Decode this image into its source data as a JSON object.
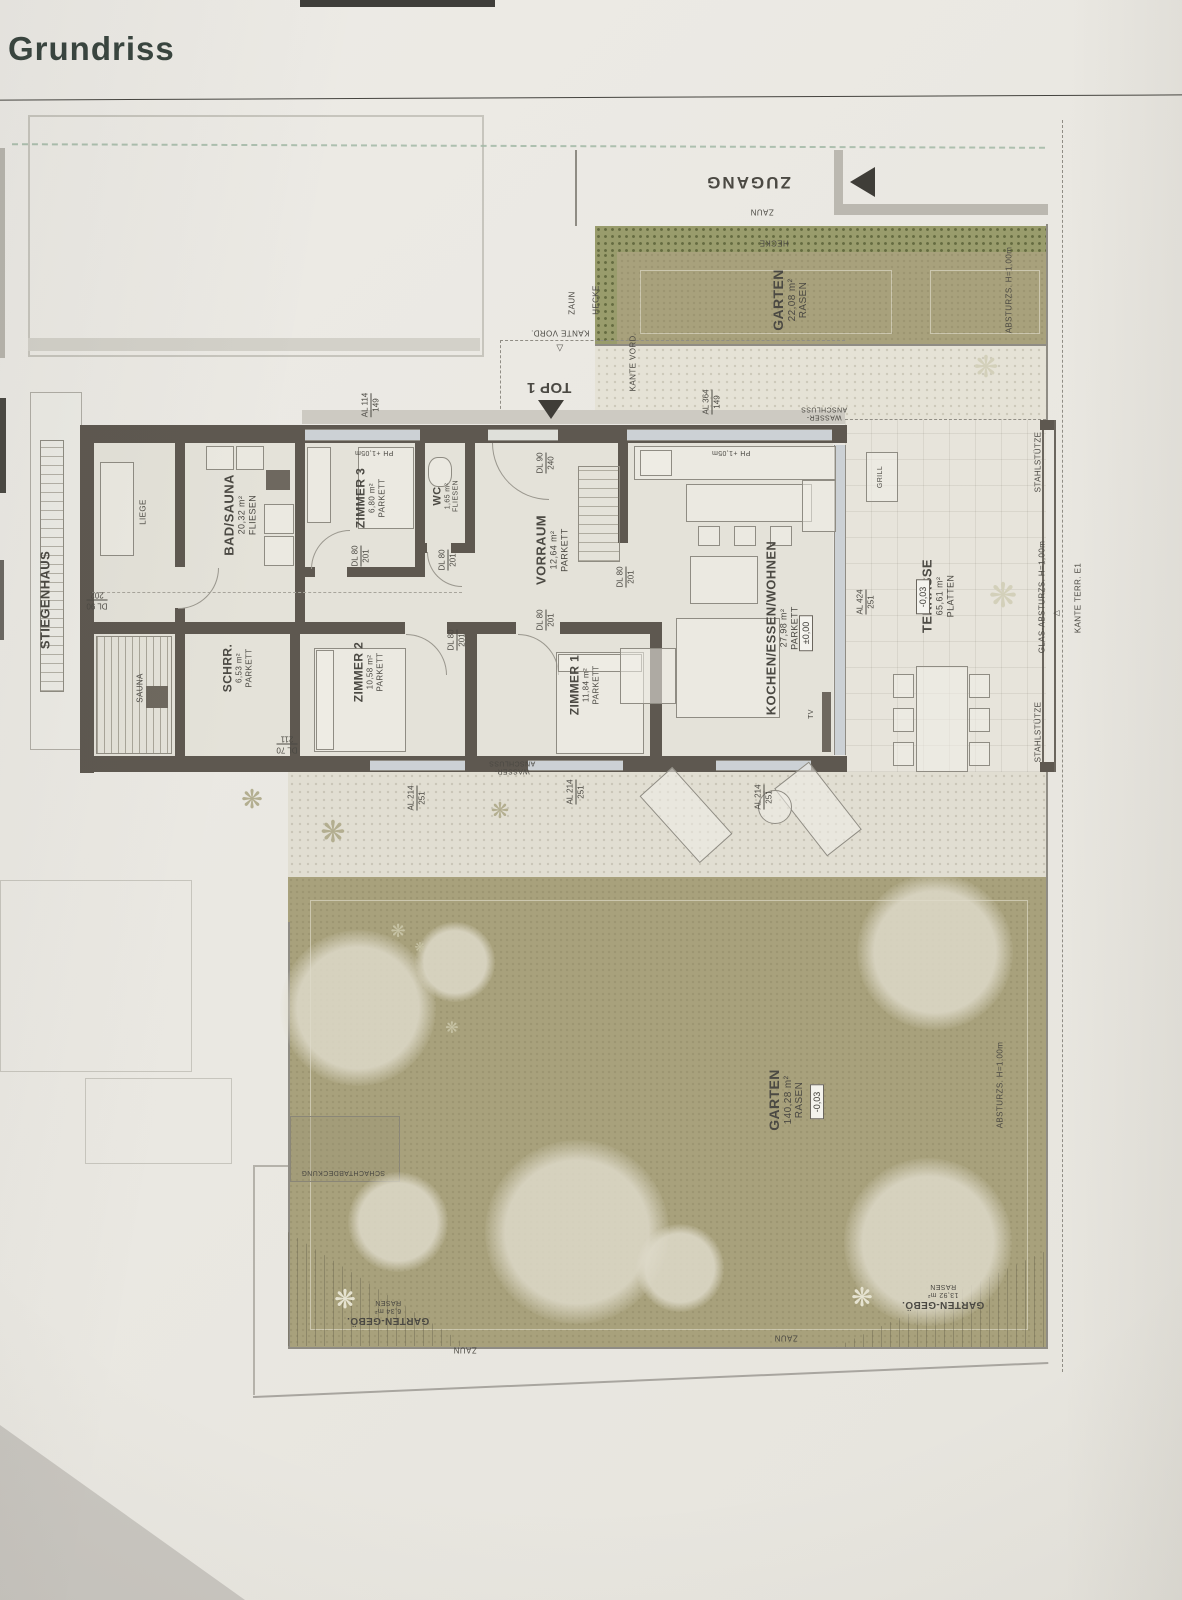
{
  "page": {
    "title": "Grundriss"
  },
  "colors": {
    "paper": "#eae8e2",
    "wall": "#5e5850",
    "lawn": "#a8a17c",
    "hedge": "#999c6c",
    "glass": "#ccd1d5",
    "text": "#4b4943",
    "title_text": "#39453f"
  },
  "plan": {
    "unit": "TOP 1",
    "labels": [
      {
        "n": "zugang-label",
        "t": [
          "ZUGANG"
        ],
        "x": 748,
        "y": 182,
        "r": 180,
        "fs": 17,
        "b": 1,
        "ls": 2
      },
      {
        "n": "zaun-top-label",
        "t": [
          "ZAUN"
        ],
        "x": 762,
        "y": 212,
        "r": 180,
        "fs": 8
      },
      {
        "n": "hecke-top-label",
        "t": [
          "HECKE"
        ],
        "x": 774,
        "y": 243,
        "r": 180,
        "fs": 8
      },
      {
        "n": "zaun-strip-left-label",
        "t": [
          "ZAUN"
        ],
        "x": 572,
        "y": 303,
        "r": -90,
        "fs": 8
      },
      {
        "n": "hecke-strip-left-label",
        "t": [
          "HECKE"
        ],
        "x": 596,
        "y": 300,
        "r": -90,
        "fs": 8
      },
      {
        "n": "garten-strip-label",
        "t": [
          "GARTEN",
          "22,08 m²",
          "RASEN"
        ],
        "x": 790,
        "y": 300,
        "r": -90,
        "fs": 14,
        "b": 1
      },
      {
        "n": "absturz-strip-label",
        "t": [
          "ABSTURZS. H=1,00m"
        ],
        "x": 1009,
        "y": 290,
        "r": -90,
        "fs": 8
      },
      {
        "n": "kante-vord-label-1",
        "t": [
          "KANTE VORD."
        ],
        "x": 560,
        "y": 333,
        "r": 180,
        "fs": 8
      },
      {
        "n": "kante-vord-marker",
        "t": [
          "▽"
        ],
        "x": 560,
        "y": 348,
        "r": 0,
        "fs": 9
      },
      {
        "n": "kante-vord-label-2",
        "t": [
          "KANTE VORD."
        ],
        "x": 633,
        "y": 362,
        "r": -90,
        "fs": 8
      },
      {
        "n": "wasser-anschluss-top-label",
        "t": [
          "WASSER-",
          "ANSCHLUSS"
        ],
        "x": 824,
        "y": 412,
        "r": 180,
        "fs": 7
      },
      {
        "n": "top1-label",
        "t": [
          "TOP 1"
        ],
        "x": 549,
        "y": 387,
        "r": 180,
        "fs": 15,
        "b": 1
      },
      {
        "n": "ph-105-left-label",
        "t": [
          "PH +1,05m"
        ],
        "x": 374,
        "y": 452,
        "r": 180,
        "fs": 7
      },
      {
        "n": "ph-105-right-label",
        "t": [
          "PH +1,05m"
        ],
        "x": 731,
        "y": 452,
        "r": 180,
        "fs": 7
      },
      {
        "n": "stiegenhaus-label",
        "t": [
          "STIEGENHAUS"
        ],
        "x": 45,
        "y": 600,
        "r": -90,
        "fs": 13,
        "b": 1
      },
      {
        "n": "liege-label",
        "t": [
          "LIEGE"
        ],
        "x": 143,
        "y": 512,
        "r": -90,
        "fs": 8
      },
      {
        "n": "room-label-bad-sauna",
        "t": [
          "BAD/SAUNA",
          "20,32 m²",
          "FLIESEN"
        ],
        "x": 240,
        "y": 515,
        "r": -90,
        "fs": 13,
        "b": 1
      },
      {
        "n": "room-label-zimmer-3",
        "t": [
          "ZIMMER 3",
          "6,80 m²",
          "PARKETT"
        ],
        "x": 370,
        "y": 498,
        "r": -90,
        "fs": 12,
        "b": 1
      },
      {
        "n": "room-label-wc",
        "t": [
          "WC",
          "1,65 m²",
          "FLIESEN"
        ],
        "x": 446,
        "y": 496,
        "r": -90,
        "fs": 11,
        "b": 1
      },
      {
        "n": "room-label-vorraum",
        "t": [
          "VORRAUM",
          "12,64 m²",
          "PARKETT"
        ],
        "x": 552,
        "y": 550,
        "r": -90,
        "fs": 13,
        "b": 1
      },
      {
        "n": "sauna-label",
        "t": [
          "SAUNA"
        ],
        "x": 140,
        "y": 688,
        "r": -90,
        "fs": 8
      },
      {
        "n": "room-label-schrankraum",
        "t": [
          "SCHRR.",
          "6,53 m²",
          "PARKETT"
        ],
        "x": 237,
        "y": 668,
        "r": -90,
        "fs": 12,
        "b": 1
      },
      {
        "n": "room-label-zimmer-2",
        "t": [
          "ZIMMER 2",
          "10,58 m²",
          "PARKETT"
        ],
        "x": 368,
        "y": 672,
        "r": -90,
        "fs": 12,
        "b": 1
      },
      {
        "n": "room-label-zimmer-1",
        "t": [
          "ZIMMER 1",
          "11,84 m²",
          "PARKETT"
        ],
        "x": 584,
        "y": 685,
        "r": -90,
        "fs": 12,
        "b": 1
      },
      {
        "n": "room-label-kochen-essen-wohnen",
        "t": [
          "KOCHEN/ESSEN/WOHNEN",
          "27,98 m²",
          "PARKETT"
        ],
        "x": 782,
        "y": 628,
        "r": -90,
        "fs": 13,
        "b": 1
      },
      {
        "n": "room-label-terrasse",
        "t": [
          "TERRASSE",
          "65,61 m²",
          "PLATTEN"
        ],
        "x": 938,
        "y": 596,
        "r": -90,
        "fs": 13,
        "b": 1
      },
      {
        "n": "grill-label",
        "t": [
          "GRILL"
        ],
        "x": 881,
        "y": 477,
        "r": -90,
        "fs": 7
      },
      {
        "n": "tv-label",
        "t": [
          "TV"
        ],
        "x": 812,
        "y": 714,
        "r": -90,
        "fs": 7
      },
      {
        "n": "wasser-anschluss-bottom-label",
        "t": [
          "WASSER-",
          "ANSCHLUSS"
        ],
        "x": 512,
        "y": 766,
        "r": 180,
        "fs": 7
      },
      {
        "n": "stahlstuetze-label-1",
        "t": [
          "STAHLSTÜTZE"
        ],
        "x": 1038,
        "y": 462,
        "r": -90,
        "fs": 8
      },
      {
        "n": "stahlstuetze-label-2",
        "t": [
          "STAHLSTÜTZE"
        ],
        "x": 1038,
        "y": 732,
        "r": -90,
        "fs": 8
      },
      {
        "n": "glas-absturz-label",
        "t": [
          "GLAS-ABSTURZS. H=1,00m"
        ],
        "x": 1042,
        "y": 597,
        "r": -90,
        "fs": 8
      },
      {
        "n": "kante-terr-marker",
        "t": [
          "△"
        ],
        "x": 1056,
        "y": 613,
        "r": -90,
        "fs": 8
      },
      {
        "n": "kante-terr-label",
        "t": [
          "KANTE TERR. E1"
        ],
        "x": 1078,
        "y": 598,
        "r": -90,
        "fs": 8
      },
      {
        "n": "garten-main-label",
        "t": [
          "GARTEN",
          "140,28 m²",
          "RASEN"
        ],
        "x": 786,
        "y": 1100,
        "r": -90,
        "fs": 14,
        "b": 1
      },
      {
        "n": "absturz-garten-label",
        "t": [
          "ABSTURZS. H=1,00m"
        ],
        "x": 1000,
        "y": 1085,
        "r": -90,
        "fs": 8
      },
      {
        "n": "schachtabdeckung-label",
        "t": [
          "SCHACHTABDECKUNG"
        ],
        "x": 343,
        "y": 1172,
        "r": 180,
        "fs": 7
      },
      {
        "n": "garten-geboe-left-label",
        "t": [
          "GARTEN-GEBÖ.",
          "6,34 m²",
          "RASEN"
        ],
        "x": 388,
        "y": 1312,
        "r": 180,
        "fs": 10,
        "b": 1
      },
      {
        "n": "garten-geboe-right-label",
        "t": [
          "GARTEN-GEBÖ.",
          "13,92 m²",
          "RASEN"
        ],
        "x": 943,
        "y": 1296,
        "r": 180,
        "fs": 10,
        "b": 1
      },
      {
        "n": "zaun-bottom-left-label",
        "t": [
          "ZAUN"
        ],
        "x": 465,
        "y": 1350,
        "r": 180,
        "fs": 8
      },
      {
        "n": "zaun-bottom-right-label",
        "t": [
          "ZAUN"
        ],
        "x": 786,
        "y": 1338,
        "r": 180,
        "fs": 8
      }
    ],
    "fracs": [
      {
        "n": "window-dim-al-364-149",
        "top": "AL 364",
        "bot": "149",
        "x": 712,
        "y": 402,
        "r": -90
      },
      {
        "n": "window-dim-al-114-149",
        "top": "AL 114",
        "bot": "149",
        "x": 371,
        "y": 405,
        "r": -90
      },
      {
        "n": "door-dim-dl-90-240",
        "top": "DL 90",
        "bot": "240",
        "x": 546,
        "y": 463,
        "r": -90
      },
      {
        "n": "door-dim-dl-80-201-z3",
        "top": "DL 80",
        "bot": "201",
        "x": 361,
        "y": 556,
        "r": -90
      },
      {
        "n": "door-dim-dl-80-201-wc",
        "top": "DL 80",
        "bot": "201",
        "x": 448,
        "y": 560,
        "r": -90
      },
      {
        "n": "door-dim-dl-80-201-z2",
        "top": "DL 80",
        "bot": "201",
        "x": 457,
        "y": 640,
        "r": -90
      },
      {
        "n": "door-dim-dl-80-201-z1",
        "top": "DL 80",
        "bot": "201",
        "x": 546,
        "y": 620,
        "r": -90
      },
      {
        "n": "door-dim-dl-80-201-kueche",
        "top": "DL 80",
        "bot": "201",
        "x": 626,
        "y": 577,
        "r": -90
      },
      {
        "n": "door-dim-dl-90-202",
        "top": "DL 90",
        "bot": "202",
        "x": 97,
        "y": 600,
        "r": 180
      },
      {
        "n": "door-dim-dl-70-211",
        "top": "DL 70",
        "bot": "211",
        "x": 287,
        "y": 744,
        "r": 180
      },
      {
        "n": "window-dim-al-214-251-a",
        "top": "AL 214",
        "bot": "251",
        "x": 417,
        "y": 798,
        "r": -90
      },
      {
        "n": "window-dim-al-214-251-b",
        "top": "AL 214",
        "bot": "251",
        "x": 576,
        "y": 792,
        "r": -90
      },
      {
        "n": "window-dim-al-214-251-c",
        "top": "AL 214",
        "bot": "251",
        "x": 764,
        "y": 797,
        "r": -90
      },
      {
        "n": "window-dim-al-424-251",
        "top": "AL 424",
        "bot": "251",
        "x": 866,
        "y": 602,
        "r": -90
      }
    ],
    "boxes": [
      {
        "n": "elevation-wohnen",
        "t": "±0,00",
        "x": 806,
        "y": 633,
        "r": -90
      },
      {
        "n": "elevation-terrasse",
        "t": "-0,03",
        "x": 923,
        "y": 597,
        "r": -90
      },
      {
        "n": "elevation-garten",
        "t": "-0,03",
        "x": 817,
        "y": 1102,
        "r": -90
      }
    ],
    "plants": [
      {
        "x": 252,
        "y": 800,
        "s": 26,
        "c": "#b3ae90"
      },
      {
        "x": 333,
        "y": 833,
        "s": 30,
        "c": "#b3ae90"
      },
      {
        "x": 500,
        "y": 812,
        "s": 22,
        "c": "#b3ae90"
      },
      {
        "x": 986,
        "y": 368,
        "s": 30,
        "c": "#d3d0ba"
      },
      {
        "x": 1003,
        "y": 596,
        "s": 34,
        "c": "#d3d0ba"
      },
      {
        "x": 398,
        "y": 932,
        "s": 18,
        "c": "#c6c2a4"
      },
      {
        "x": 452,
        "y": 1028,
        "s": 16,
        "c": "#c6c2a4"
      },
      {
        "x": 420,
        "y": 948,
        "s": 13,
        "c": "#c6c2a4"
      },
      {
        "x": 345,
        "y": 1300,
        "s": 26,
        "c": "#e6e3d1"
      },
      {
        "x": 862,
        "y": 1298,
        "s": 26,
        "c": "#e6e3d1"
      }
    ],
    "trees": [
      {
        "x": 935,
        "y": 952,
        "r": 78
      },
      {
        "x": 358,
        "y": 1008,
        "r": 78
      },
      {
        "x": 577,
        "y": 1232,
        "r": 92
      },
      {
        "x": 928,
        "y": 1242,
        "r": 84
      },
      {
        "x": 398,
        "y": 1222,
        "r": 50
      },
      {
        "x": 680,
        "y": 1268,
        "r": 44
      },
      {
        "x": 455,
        "y": 962,
        "r": 40
      }
    ]
  }
}
